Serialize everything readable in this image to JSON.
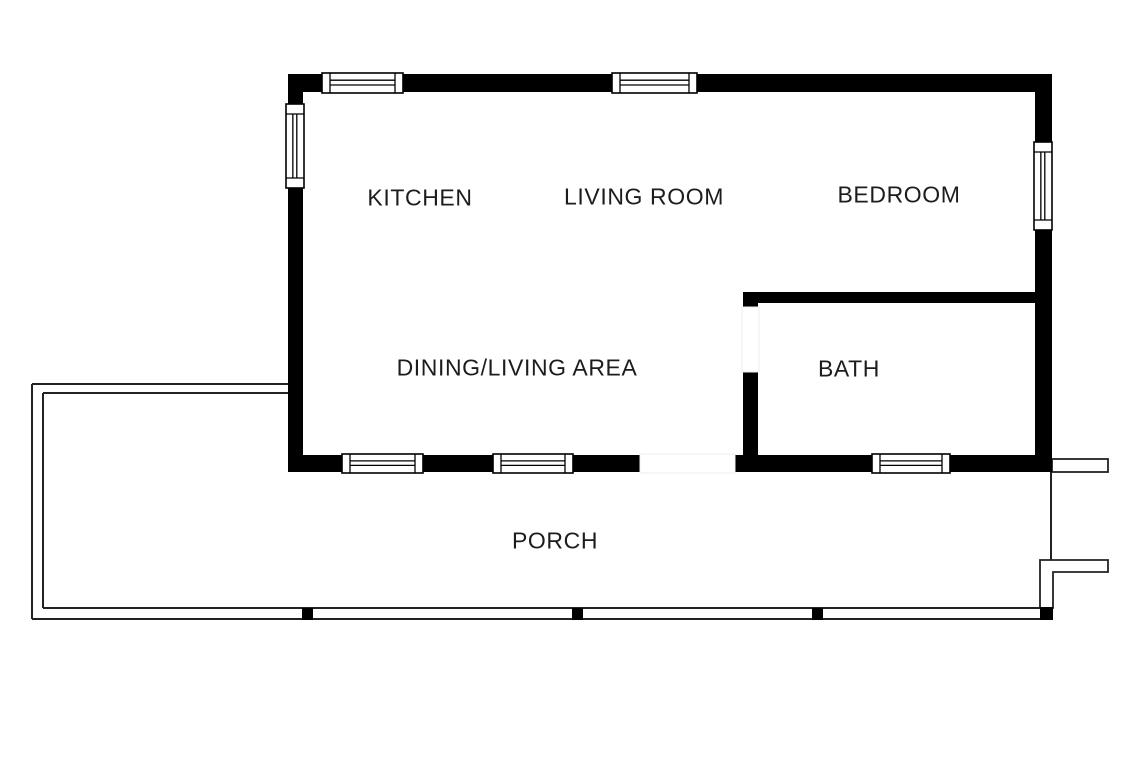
{
  "title": "One-bedroom cabin floor plan with porch",
  "colors": {
    "wall": "#000000",
    "line": "#222222",
    "bg": "#ffffff",
    "opening_edge": "#ececec"
  },
  "rooms": [
    {
      "name": "kitchen",
      "label": "KITCHEN",
      "cx": 420,
      "cy": 198
    },
    {
      "name": "living-room",
      "label": "LIVING ROOM",
      "cx": 644,
      "cy": 197
    },
    {
      "name": "bedroom",
      "label": "BEDROOM",
      "cx": 899,
      "cy": 195
    },
    {
      "name": "dining-living-area",
      "label": "DINING/LIVING AREA",
      "cx": 517,
      "cy": 368
    },
    {
      "name": "bath",
      "label": "BATH",
      "cx": 849,
      "cy": 369
    },
    {
      "name": "porch",
      "label": "PORCH",
      "cx": 555,
      "cy": 541
    }
  ],
  "plan": {
    "walls": [
      {
        "name": "exterior-wall-top",
        "x": 288,
        "y": 74,
        "w": 764,
        "h": 18
      },
      {
        "name": "exterior-wall-left",
        "x": 288,
        "y": 74,
        "w": 15,
        "h": 398
      },
      {
        "name": "exterior-wall-right",
        "x": 1035,
        "y": 74,
        "w": 17,
        "h": 398
      },
      {
        "name": "exterior-wall-bottom",
        "x": 288,
        "y": 455,
        "w": 764,
        "h": 17
      },
      {
        "name": "bath-wall-top",
        "x": 743,
        "y": 292,
        "w": 292,
        "h": 11
      },
      {
        "name": "bath-wall-left",
        "x": 743,
        "y": 292,
        "w": 15,
        "h": 180
      }
    ],
    "door_openings": [
      {
        "name": "porch-door-opening",
        "x": 640,
        "y": 454,
        "w": 95,
        "h": 19
      },
      {
        "name": "bath-door-opening",
        "x": 742,
        "y": 307,
        "w": 17,
        "h": 65
      }
    ],
    "windows": [
      {
        "name": "window-top-kitchen",
        "x": 322,
        "y": 73,
        "w": 81,
        "h": 20,
        "o": "h"
      },
      {
        "name": "window-top-living",
        "x": 612,
        "y": 73,
        "w": 85,
        "h": 20,
        "o": "h"
      },
      {
        "name": "window-left-kitchen",
        "x": 286,
        "y": 104,
        "w": 18,
        "h": 84,
        "o": "v"
      },
      {
        "name": "window-right-bedroom",
        "x": 1034,
        "y": 142,
        "w": 18,
        "h": 88,
        "o": "v"
      },
      {
        "name": "window-bottom-dining-1",
        "x": 342,
        "y": 454,
        "w": 81,
        "h": 19,
        "o": "h"
      },
      {
        "name": "window-bottom-dining-2",
        "x": 493,
        "y": 454,
        "w": 80,
        "h": 19,
        "o": "h"
      },
      {
        "name": "window-bottom-bath",
        "x": 872,
        "y": 454,
        "w": 78,
        "h": 19,
        "o": "h"
      }
    ],
    "porch_lines": [
      {
        "name": "porch-outer-left",
        "x1": 32,
        "y1": 384,
        "x2": 32,
        "y2": 619
      },
      {
        "name": "porch-outer-top",
        "x1": 32,
        "y1": 384,
        "x2": 288,
        "y2": 384
      },
      {
        "name": "porch-outer-bottom",
        "x1": 32,
        "y1": 619,
        "x2": 1052,
        "y2": 619
      },
      {
        "name": "porch-inner-left",
        "x1": 43,
        "y1": 393,
        "x2": 43,
        "y2": 608
      },
      {
        "name": "porch-inner-top",
        "x1": 43,
        "y1": 393,
        "x2": 288,
        "y2": 393
      },
      {
        "name": "porch-inner-bottom",
        "x1": 43,
        "y1": 608,
        "x2": 1040,
        "y2": 608
      },
      {
        "name": "porch-step-riser",
        "x1": 1051,
        "y1": 472,
        "x2": 1051,
        "y2": 561
      }
    ],
    "posts": [
      {
        "name": "porch-post-1",
        "x": 302,
        "y": 608,
        "w": 11,
        "h": 12
      },
      {
        "name": "porch-post-2",
        "x": 572,
        "y": 608,
        "w": 11,
        "h": 12
      },
      {
        "name": "porch-post-3",
        "x": 812,
        "y": 608,
        "w": 11,
        "h": 12
      },
      {
        "name": "porch-post-corner",
        "x": 1040,
        "y": 607,
        "w": 13,
        "h": 13
      }
    ],
    "steps": [
      {
        "name": "side-step-upper",
        "type": "rect",
        "x": 1052,
        "y": 459,
        "w": 56,
        "h": 13
      },
      {
        "name": "side-step-lower",
        "type": "path",
        "d": "M 1040 560 H 1108 V 572 H 1053 V 608 H 1040 Z"
      }
    ]
  }
}
